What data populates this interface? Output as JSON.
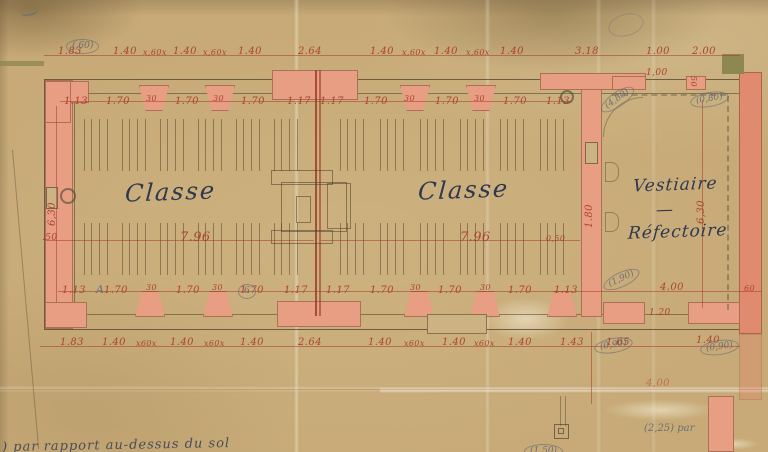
{
  "plan": {
    "rooms": {
      "classe_left": "Classe",
      "classe_right": "Classe",
      "vestiaire_line1": "Vestiaire",
      "vestiaire_sep": "—",
      "vestiaire_line2": "Réfectoire"
    },
    "dim_rows": {
      "top_outer": [
        "1.83",
        "1.40",
        "x,60x",
        "1.40",
        "x,60x",
        "1.40",
        "2.64",
        "1.40",
        "x,60x",
        "1.40",
        "x,60x",
        "1.40",
        "3.18",
        "1.00",
        "2.00"
      ],
      "top_inner": [
        "1.13",
        "1.70",
        "30",
        "1.70",
        "30",
        "1.70",
        "1.17",
        "1.17",
        "1.70",
        "30",
        "1.70",
        "30",
        "1.70",
        "1.13"
      ],
      "mid": [
        ".50",
        "7.96",
        "7.96",
        "0,50"
      ],
      "bottom_inner": [
        "1.13",
        "1.70",
        "30",
        "1.70",
        "30",
        "1.70",
        "1.17",
        "1.17",
        "1.70",
        "30",
        "1.70",
        "30",
        "1.70",
        "1.13",
        "4.00",
        "60"
      ],
      "bottom_outer": [
        "1.83",
        "1.40",
        "x60x",
        "1.40",
        "x60x",
        "1.40",
        "2.64",
        "1.40",
        "x60x",
        "1.40",
        "x60x",
        "1.40",
        "1.43",
        "1.65",
        "1.40"
      ],
      "baseline": [
        "4,00"
      ]
    },
    "vertical_dims": {
      "left_height": "6,30",
      "vestiaire_height": "6,30",
      "passage": "1.80",
      "vestiaire_door": "1.20",
      "vestiaire_window": "1,00",
      "pier": "50"
    },
    "pencil_notes": [
      "(,60)",
      "(4,80)",
      "(0,80)",
      "(1,90)",
      "(0,90)",
      "(0,90)",
      "(1,50)",
      "(2,25) par",
      "A",
      "6"
    ],
    "handwriting": {
      "bottom_left": ") par rapport au-dessus du sol"
    }
  },
  "colors": {
    "paper": "#c7aa77",
    "wall_fill": "#e79e83",
    "wall_deep": "#e08a6f",
    "dim_red": "#a93c2b",
    "pencil": "#5d6575",
    "ink": "#2f3850",
    "olive": "#8e8752"
  }
}
